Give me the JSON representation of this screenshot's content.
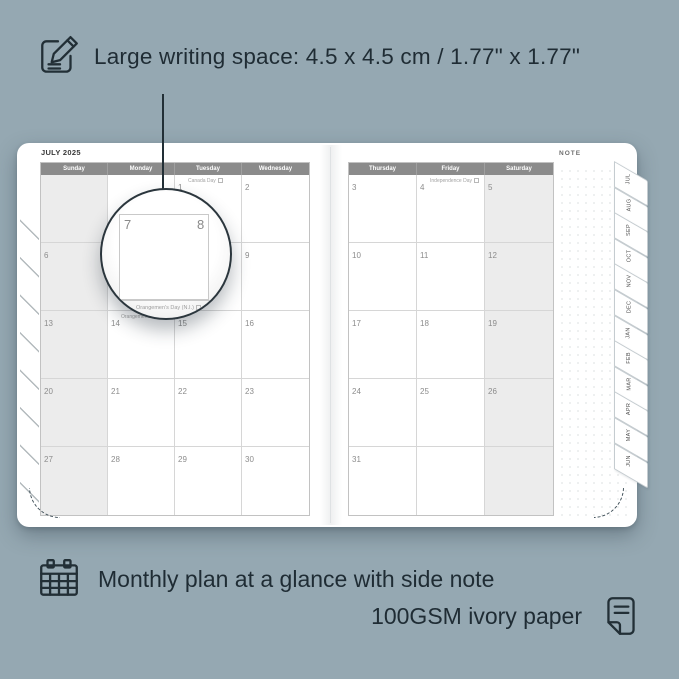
{
  "colors": {
    "background": "#95a8b2",
    "ink": "#1f2c34",
    "page": "#ffffff",
    "header_bar": "#8b8b8b",
    "weekend_fill": "#ececec"
  },
  "features": {
    "top": {
      "icon": "pencil-note-icon",
      "text": "Large writing space: 4.5 x 4.5 cm / 1.77\" x 1.77\""
    },
    "bottom_primary": {
      "icon": "calendar-grid-icon",
      "text": "Monthly plan at a glance with side note"
    },
    "bottom_secondary": {
      "icon": "paper-icon",
      "text": "100GSM ivory paper"
    }
  },
  "planner": {
    "month_title": "JULY 2025",
    "note_label": "NOTE",
    "month_tabs": [
      "JUL",
      "AUG",
      "SEP",
      "OCT",
      "NOV",
      "DEC",
      "JAN",
      "FEB",
      "MAR",
      "APR",
      "MAY",
      "JUN"
    ],
    "left_page": {
      "day_headers": [
        "Sunday",
        "Monday",
        "Tuesday",
        "Wednesday"
      ],
      "weeks": [
        [
          {
            "date": ""
          },
          {
            "date": ""
          },
          {
            "date": "1",
            "holiday": "Canada Day"
          },
          {
            "date": "2"
          }
        ],
        [
          {
            "date": "6"
          },
          {
            "date": "7"
          },
          {
            "date": "8"
          },
          {
            "date": "9"
          }
        ],
        [
          {
            "date": "13"
          },
          {
            "date": "14",
            "holiday": "Orangemen's Day (N.I.)"
          },
          {
            "date": "15"
          },
          {
            "date": "16"
          }
        ],
        [
          {
            "date": "20"
          },
          {
            "date": "21"
          },
          {
            "date": "22"
          },
          {
            "date": "23"
          }
        ],
        [
          {
            "date": "27"
          },
          {
            "date": "28"
          },
          {
            "date": "29"
          },
          {
            "date": "30"
          }
        ]
      ]
    },
    "right_page": {
      "day_headers": [
        "Thursday",
        "Friday",
        "Saturday"
      ],
      "weeks": [
        [
          {
            "date": "3"
          },
          {
            "date": "4",
            "holiday": "Independence Day"
          },
          {
            "date": "5"
          }
        ],
        [
          {
            "date": "10"
          },
          {
            "date": "11"
          },
          {
            "date": "12"
          }
        ],
        [
          {
            "date": "17"
          },
          {
            "date": "18"
          },
          {
            "date": "19"
          }
        ],
        [
          {
            "date": "24"
          },
          {
            "date": "25"
          },
          {
            "date": "26"
          }
        ],
        [
          {
            "date": "31"
          },
          {
            "date": ""
          },
          {
            "date": ""
          }
        ]
      ]
    }
  },
  "magnifier": {
    "date_left": "7",
    "date_right": "8",
    "below_date": "4",
    "below_holiday": "Orangemen's Day (N.I.)"
  }
}
